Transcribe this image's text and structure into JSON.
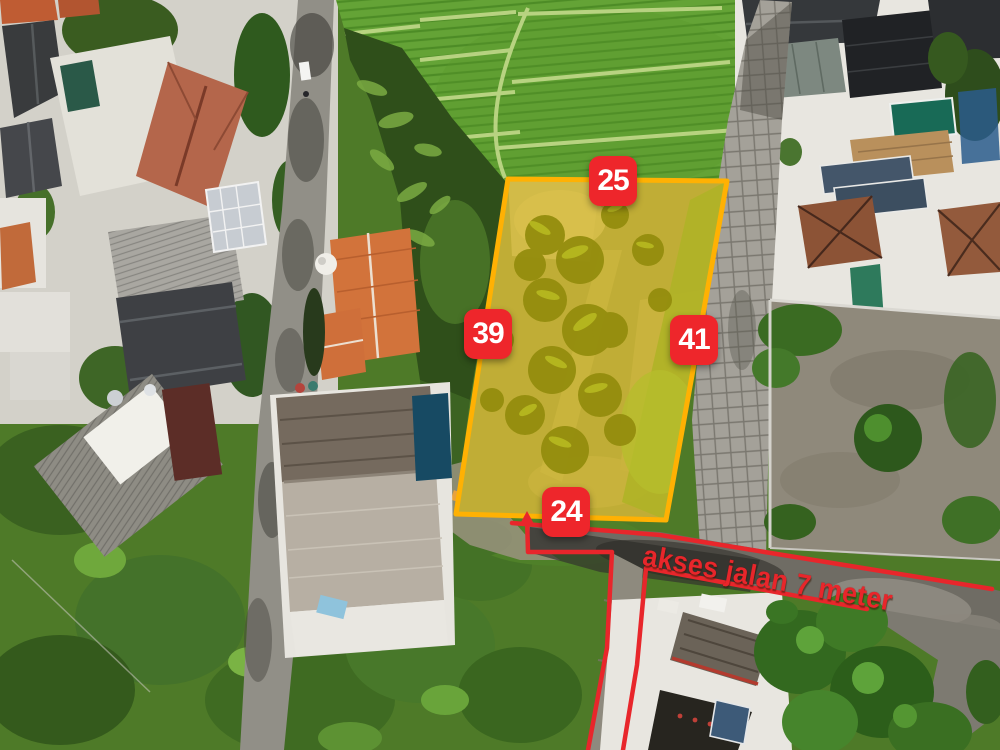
{
  "annotations": {
    "plot_dimensions_m": {
      "top": "25",
      "left": "39",
      "right": "41",
      "bottom": "24"
    },
    "road_label": "akses jalan 7 meter",
    "colors": {
      "badge_bg": "#ee262b",
      "badge_text": "#ffffff",
      "plot_border": "#ffb103",
      "plot_fill": "#ffd800",
      "road_line": "#e8262b",
      "road_text": "#e8262b"
    }
  }
}
